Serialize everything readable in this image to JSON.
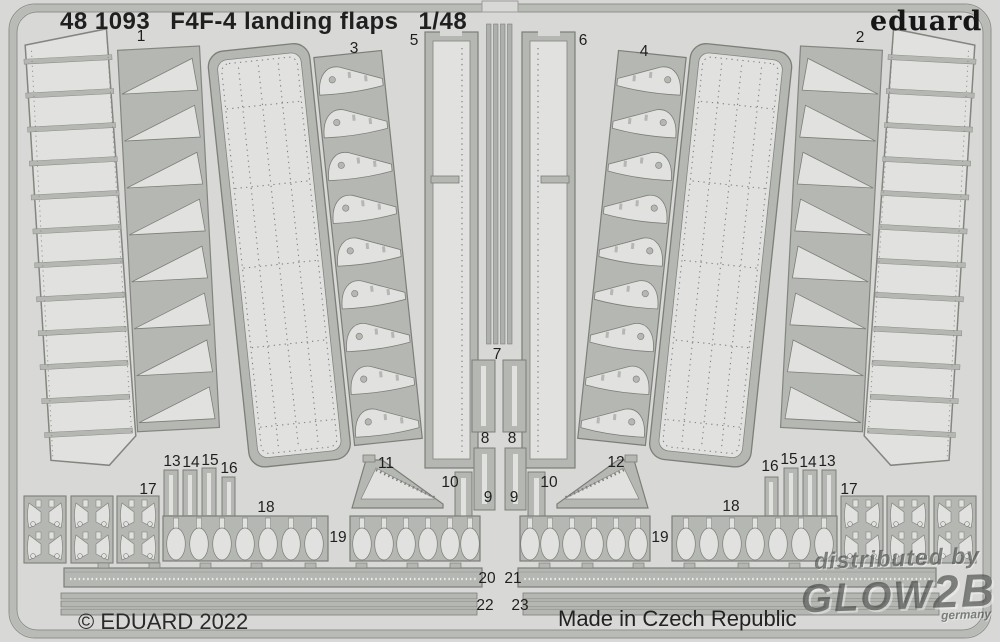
{
  "header": {
    "catalog_number": "48 1093",
    "title": "F4F-4 landing flaps",
    "scale": "1/48"
  },
  "brand": {
    "logo": "eduard"
  },
  "footer": {
    "copyright": "© EDUARD 2022",
    "origin": "Made in Czech Republic"
  },
  "watermark": {
    "line1": "distributed by",
    "glow": "GLOW",
    "b2": "2B",
    "country": "germany"
  },
  "colors": {
    "bg": "#d8d9d7",
    "light": "#e1e2e0",
    "gray": "#b5b7b3",
    "outline": "#7c7e78",
    "edge": "#8e908c",
    "band": "#b9bbb7",
    "text": "#1f1f1f"
  },
  "part_labels": [
    {
      "n": "1",
      "x": 141,
      "y": 37
    },
    {
      "n": "2",
      "x": 860,
      "y": 38
    },
    {
      "n": "3",
      "x": 354,
      "y": 49
    },
    {
      "n": "4",
      "x": 644,
      "y": 52
    },
    {
      "n": "5",
      "x": 414,
      "y": 41
    },
    {
      "n": "6",
      "x": 583,
      "y": 41
    },
    {
      "n": "7",
      "x": 497,
      "y": 355
    },
    {
      "n": "8",
      "x": 485,
      "y": 439
    },
    {
      "n": "8",
      "x": 512,
      "y": 439
    },
    {
      "n": "9",
      "x": 488,
      "y": 498
    },
    {
      "n": "9",
      "x": 514,
      "y": 498
    },
    {
      "n": "10",
      "x": 450,
      "y": 483
    },
    {
      "n": "10",
      "x": 549,
      "y": 483
    },
    {
      "n": "11",
      "x": 386,
      "y": 464
    },
    {
      "n": "12",
      "x": 616,
      "y": 463
    },
    {
      "n": "13",
      "x": 172,
      "y": 462
    },
    {
      "n": "14",
      "x": 191,
      "y": 463
    },
    {
      "n": "15",
      "x": 210,
      "y": 461
    },
    {
      "n": "16",
      "x": 229,
      "y": 469
    },
    {
      "n": "16",
      "x": 770,
      "y": 467
    },
    {
      "n": "15",
      "x": 789,
      "y": 460
    },
    {
      "n": "14",
      "x": 808,
      "y": 463
    },
    {
      "n": "13",
      "x": 827,
      "y": 462
    },
    {
      "n": "17",
      "x": 148,
      "y": 490
    },
    {
      "n": "17",
      "x": 849,
      "y": 490
    },
    {
      "n": "18",
      "x": 266,
      "y": 508
    },
    {
      "n": "18",
      "x": 731,
      "y": 507
    },
    {
      "n": "19",
      "x": 338,
      "y": 538
    },
    {
      "n": "19",
      "x": 660,
      "y": 538
    },
    {
      "n": "20",
      "x": 487,
      "y": 579
    },
    {
      "n": "21",
      "x": 513,
      "y": 579
    },
    {
      "n": "22",
      "x": 485,
      "y": 606
    },
    {
      "n": "23",
      "x": 520,
      "y": 606
    }
  ]
}
